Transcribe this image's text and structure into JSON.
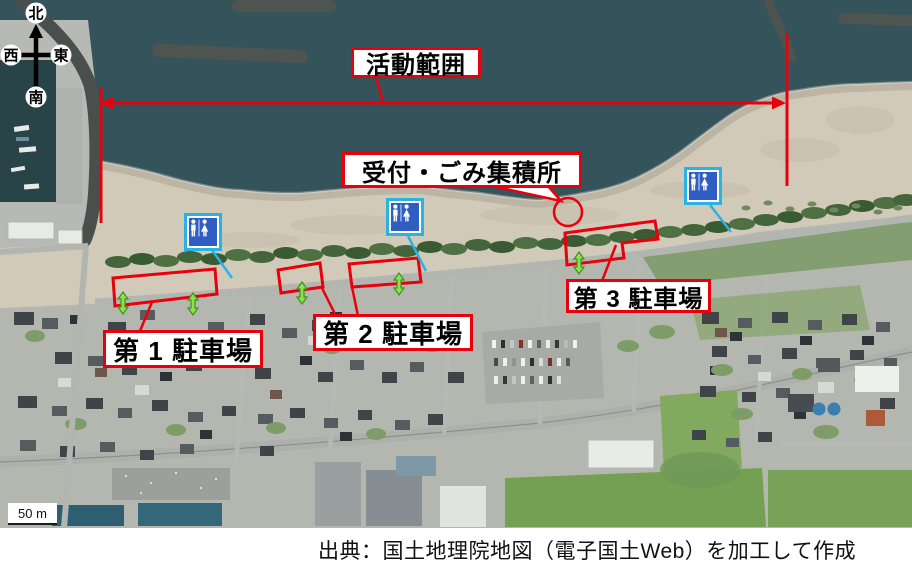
{
  "labels": {
    "activity_range": "活動範囲",
    "reception": "受付・ごみ集積所",
    "parking": [
      "第 1 駐車場",
      "第 2 駐車場",
      "第 3 駐車場"
    ]
  },
  "compass": {
    "north": "北",
    "south": "南",
    "east": "東",
    "west": "西"
  },
  "scale_bar": {
    "label": "50 m"
  },
  "attribution": "出典：国土地理院地図（電子国土Web）を加工して作成",
  "icons": {
    "toilet": "male-female-restroom-pictogram"
  },
  "colors": {
    "annotation_red": "#e8000d",
    "pointer_blue": "#2ab2e4",
    "arrow_green": "#8ee04c",
    "toilet_blue": "#2e5ec4",
    "toilet_frame_blue": "#2ab2e4",
    "ocean": "#35535a",
    "sand": "#d1cab9"
  }
}
